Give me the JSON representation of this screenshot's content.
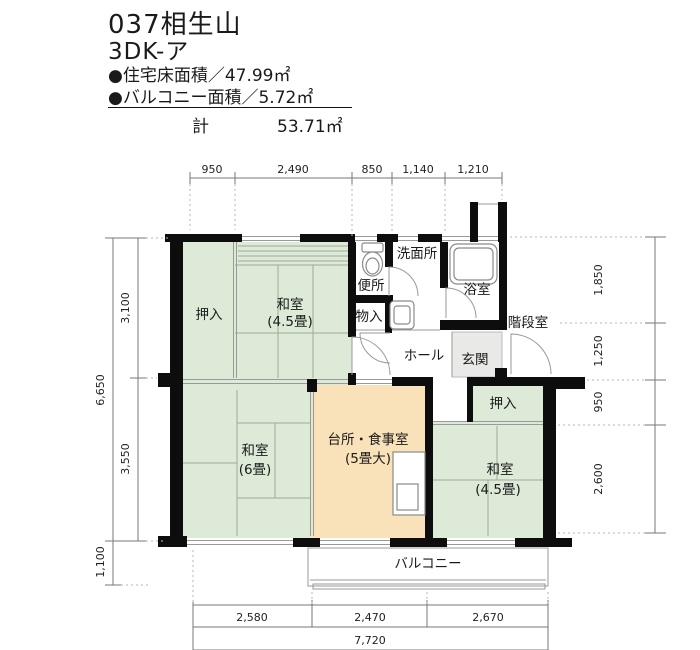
{
  "header": {
    "title": "037相生山",
    "plan_type": "3DK-ア",
    "floor_area": "●住宅床面積／47.99㎡",
    "balcony_area": "●バルコニー面積／5.72㎡",
    "total_label": "計",
    "total_value": "53.71㎡"
  },
  "dimensions": {
    "top": [
      "950",
      "2,490",
      "850",
      "1,140",
      "1,210"
    ],
    "left_outer": [
      "6,650",
      "1,100"
    ],
    "left_inner": [
      "3,100",
      "3,550"
    ],
    "right": [
      "1,850",
      "1,250",
      "950",
      "2,600"
    ],
    "bottom": [
      "2,580",
      "2,470",
      "2,670"
    ],
    "bottom_total": "7,720"
  },
  "rooms": {
    "oshiire_tl": "押入",
    "washitsu_tl_name": "和室",
    "washitsu_tl_size": "(4.5畳)",
    "benjo": "便所",
    "senmenjo": "洗面所",
    "mononoiri": "物入",
    "yokushitsu": "浴室",
    "hall": "ホール",
    "genkan": "玄関",
    "kaidanshitsu": "階段室",
    "washitsu_bl_name": "和室",
    "washitsu_bl_size": "(6畳)",
    "daidokoro_name": "台所・食事室",
    "daidokoro_size": "(5畳大)",
    "oshiire_br": "押入",
    "washitsu_br_name": "和室",
    "washitsu_br_size": "(4.5畳)",
    "balcony": "バルコニー"
  },
  "colors": {
    "tatami_room": "#dcead7",
    "kitchen_room": "#f9e1ba",
    "genkan_tile": "#e9e9e7",
    "wall": "#0d0d0d"
  }
}
